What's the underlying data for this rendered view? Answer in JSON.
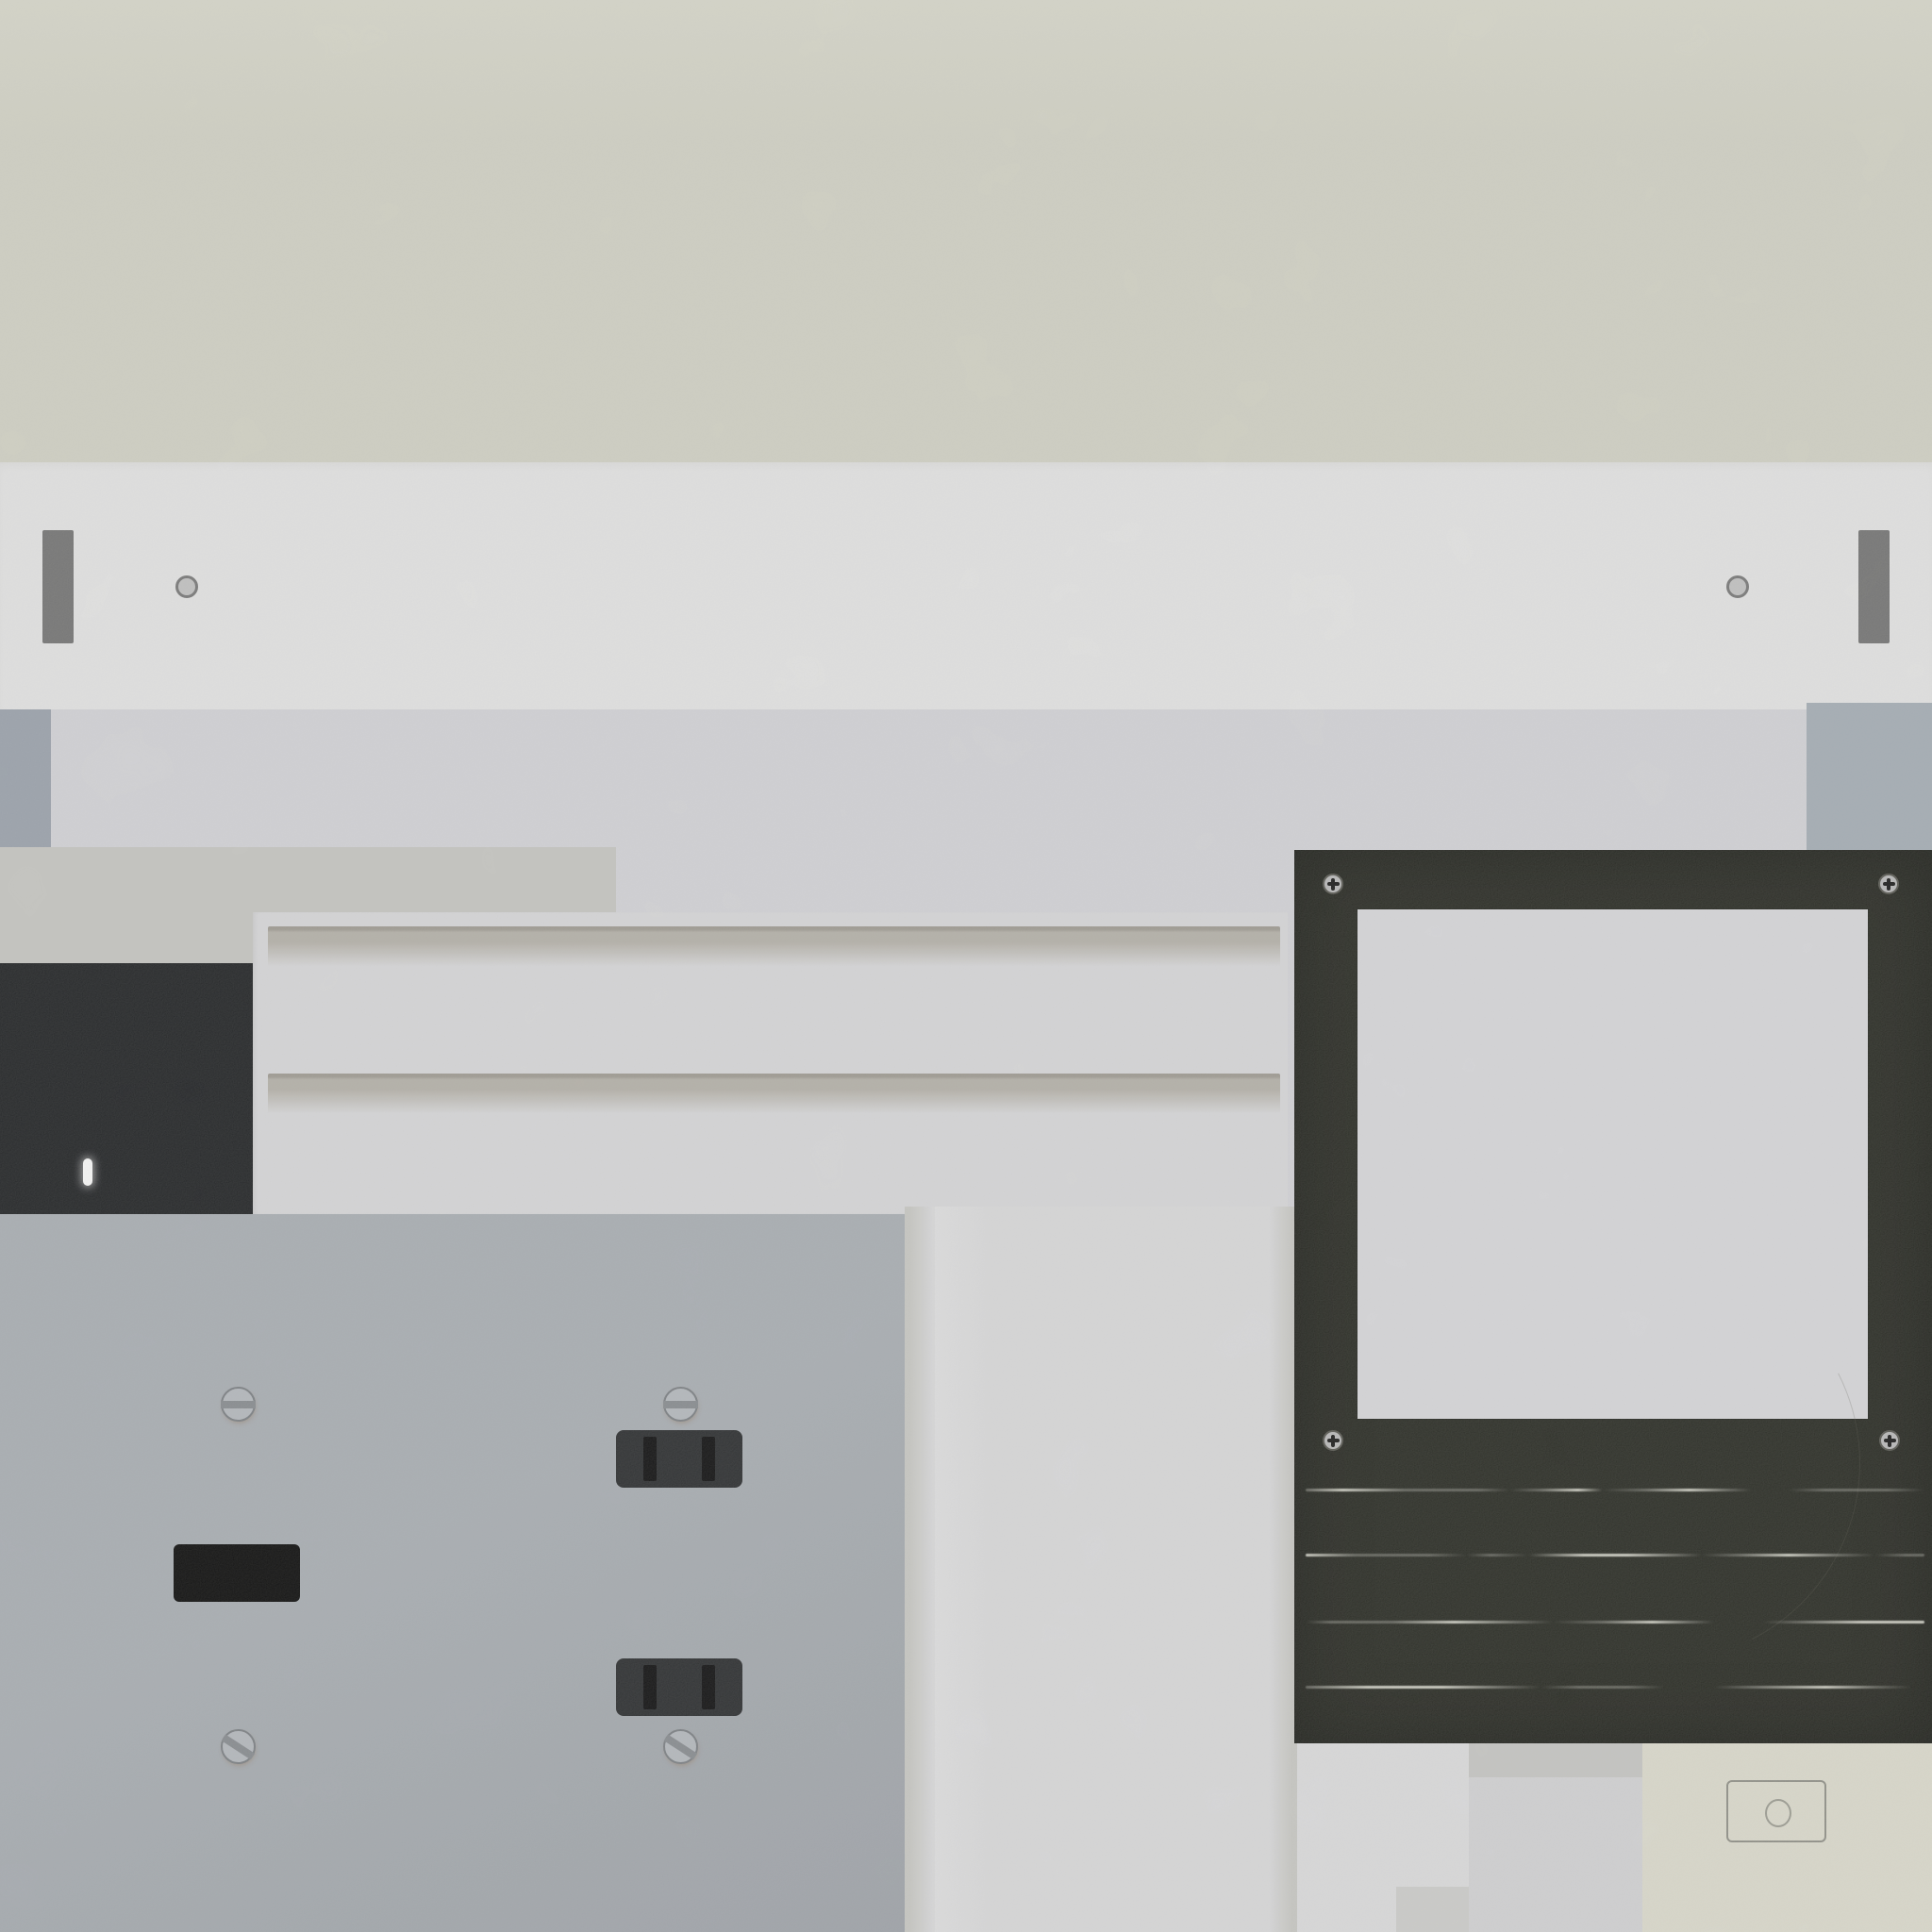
{
  "scene_title": "",
  "palette": {
    "wall_top": "#d2d2c5",
    "wall_top_hi": "#d8d8cb",
    "wall_top_fade": "#d0d0c300",
    "band_light": "#e5e5e5",
    "soft_shadow": "#00000014",
    "slot_dark": "#717171",
    "peephole_fill": "#c2c2c2",
    "peephole_ring": "#757575",
    "band_lavender": "#d4d4d8",
    "corner_left": "#99a1ab",
    "corner_right": "#a4acb5",
    "band_green": "#c6c6c2",
    "white_panel": "#d8d8da",
    "groove_line": "#9d9991",
    "groove_band": "#b4b0a8",
    "groove_fade": "#b4b0a800",
    "black_panel": "#191b1e",
    "pill_white": "#fbfbfb",
    "pill_glow": "#ffffff8c",
    "big_panel": "#a8adb3",
    "big_panel_deep": "#9da2a8",
    "screw_fill": "#b4b8be",
    "screw_ring": "#787c81",
    "screw_slot": "#85898e",
    "rust": "#8b5e3466",
    "outlet_body": "#242628",
    "outlet_slot": "#070708",
    "label_black": "#040404",
    "strip_base": "#dadadc",
    "strip_edge": "#c8c8c4",
    "strip_hi": "#e2e2e4b3",
    "strip_fade": "#e2e2e400",
    "dark_panel": "#22241d",
    "dark_vignette": "#00000059",
    "inset_square": "#d8d8dc",
    "inset_edge": "#00000022",
    "phillips_fill": "#b9b9b9",
    "phillips_ring": "#55554f",
    "phillips_cross": "#141414",
    "scratch_a": "#e8e8ddd9",
    "scratch_b": "#b9b9b266",
    "arc": "#5a5c5040",
    "none": "#00000000",
    "col_light": "#dcdcde",
    "col_block": "#cdcdcb",
    "col_mid": "#d3d3d5",
    "col_mid_band": "#c6c6c4",
    "beige_lower": "#dcdbce",
    "plate_outline": "#8e8e86",
    "ellipse_outline": "#9a9a90"
  }
}
